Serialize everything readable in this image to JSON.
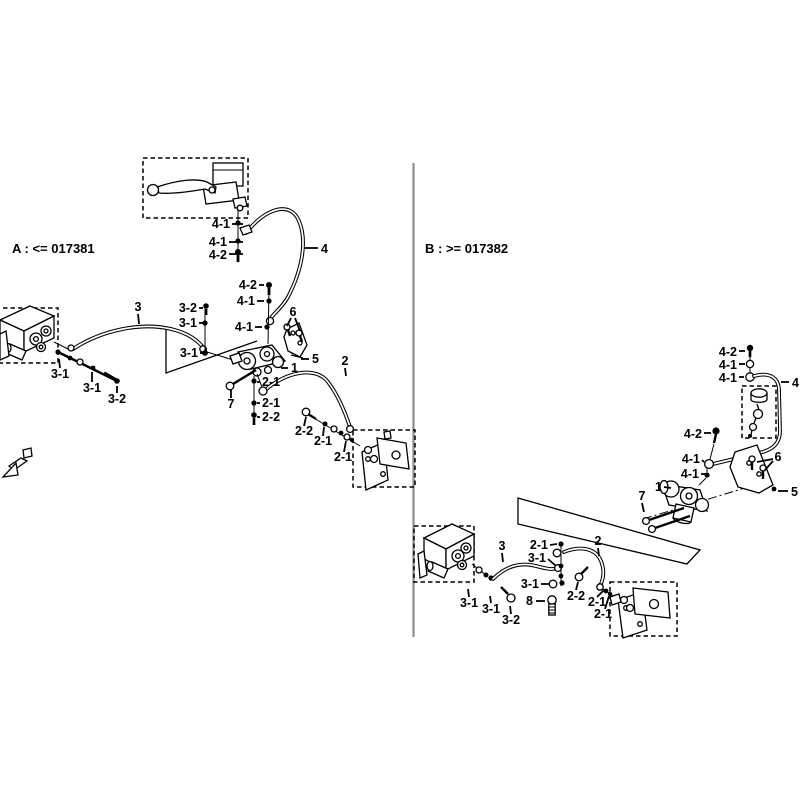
{
  "figure": {
    "background": "#ffffff",
    "line_color": "#000000",
    "divider_color": "#8c8c8c"
  },
  "sections": {
    "a": {
      "title": "A : <= 017381"
    },
    "b": {
      "title": "B : >= 017382"
    }
  },
  "callouts": [
    {
      "s": "A",
      "t": "4-1",
      "x": 230,
      "y": 228,
      "a": "end",
      "l": [
        232,
        224,
        243,
        224
      ]
    },
    {
      "s": "A",
      "t": "4-1",
      "x": 227,
      "y": 246,
      "a": "end",
      "l": [
        229,
        242,
        243,
        242
      ]
    },
    {
      "s": "A",
      "t": "4-2",
      "x": 227,
      "y": 259,
      "a": "end",
      "l": [
        229,
        254,
        243,
        254
      ]
    },
    {
      "s": "A",
      "t": "4",
      "x": 321,
      "y": 253,
      "a": "start",
      "l": [
        304,
        248,
        318,
        248
      ]
    },
    {
      "s": "A",
      "t": "4-2",
      "x": 257,
      "y": 289,
      "a": "end",
      "l": [
        259,
        285,
        264,
        285
      ]
    },
    {
      "s": "A",
      "t": "4-1",
      "x": 255,
      "y": 305,
      "a": "end",
      "l": [
        257,
        301,
        264,
        301
      ]
    },
    {
      "s": "A",
      "t": "4-1",
      "x": 253,
      "y": 331,
      "a": "end",
      "l": [
        255,
        327,
        262,
        327
      ]
    },
    {
      "s": "A",
      "t": "6",
      "x": 293,
      "y": 316,
      "a": "middle",
      "l": [
        291,
        318,
        287,
        326
      ],
      "l2": [
        295,
        318,
        300,
        331
      ]
    },
    {
      "s": "A",
      "t": "5",
      "x": 312,
      "y": 363,
      "a": "start",
      "l": [
        301,
        359,
        309,
        359
      ]
    },
    {
      "s": "A",
      "t": "1",
      "x": 291,
      "y": 372,
      "a": "start",
      "l": [
        281,
        368,
        288,
        368
      ]
    },
    {
      "s": "A",
      "t": "2",
      "x": 345,
      "y": 365,
      "a": "middle",
      "l": [
        345,
        368,
        346,
        376
      ]
    },
    {
      "s": "A",
      "t": "3",
      "x": 138,
      "y": 311,
      "a": "middle",
      "l": [
        138,
        314,
        139,
        324
      ]
    },
    {
      "s": "A",
      "t": "3-2",
      "x": 197,
      "y": 312,
      "a": "end",
      "l": [
        199,
        308,
        203,
        308
      ]
    },
    {
      "s": "A",
      "t": "3-1",
      "x": 197,
      "y": 327,
      "a": "end",
      "l": [
        199,
        323,
        203,
        323
      ]
    },
    {
      "s": "A",
      "t": "3-1",
      "x": 198,
      "y": 357,
      "a": "end",
      "l": [
        200,
        353,
        203,
        353
      ]
    },
    {
      "s": "A",
      "t": "3-1",
      "x": 60,
      "y": 378,
      "a": "middle",
      "l": [
        60,
        368,
        59,
        359
      ]
    },
    {
      "s": "A",
      "t": "3-1",
      "x": 92,
      "y": 392,
      "a": "middle",
      "l": [
        92,
        382,
        92,
        372
      ]
    },
    {
      "s": "A",
      "t": "3-2",
      "x": 117,
      "y": 403,
      "a": "middle",
      "l": [
        117,
        393,
        117,
        386
      ]
    },
    {
      "s": "A",
      "t": "7",
      "x": 231,
      "y": 408,
      "a": "middle",
      "l": [
        231,
        398,
        231,
        390
      ]
    },
    {
      "s": "A",
      "t": "2-1",
      "x": 262,
      "y": 386,
      "a": "start",
      "l": [
        257,
        382,
        260,
        382
      ]
    },
    {
      "s": "A",
      "t": "2-1",
      "x": 262,
      "y": 407,
      "a": "start",
      "l": [
        257,
        403,
        260,
        403
      ]
    },
    {
      "s": "A",
      "t": "2-2",
      "x": 262,
      "y": 421,
      "a": "start",
      "l": [
        257,
        417,
        260,
        417
      ]
    },
    {
      "s": "A",
      "t": "2-2",
      "x": 304,
      "y": 435,
      "a": "middle",
      "l": [
        304,
        426,
        306,
        417
      ]
    },
    {
      "s": "A",
      "t": "2-1",
      "x": 323,
      "y": 445,
      "a": "middle",
      "l": [
        323,
        436,
        324,
        427
      ]
    },
    {
      "s": "A",
      "t": "2-1",
      "x": 343,
      "y": 461,
      "a": "middle",
      "l": [
        344,
        452,
        346,
        441
      ]
    },
    {
      "s": "B",
      "t": "4-2",
      "x": 737,
      "y": 356,
      "a": "end",
      "l": [
        739,
        351,
        745,
        351
      ]
    },
    {
      "s": "B",
      "t": "4-1",
      "x": 737,
      "y": 369,
      "a": "end",
      "l": [
        739,
        364,
        745,
        364
      ]
    },
    {
      "s": "B",
      "t": "4-1",
      "x": 737,
      "y": 382,
      "a": "end",
      "l": [
        739,
        377,
        744,
        377
      ]
    },
    {
      "s": "B",
      "t": "4",
      "x": 792,
      "y": 387,
      "a": "start",
      "l": [
        781,
        382,
        789,
        382
      ]
    },
    {
      "s": "B",
      "t": "4-2",
      "x": 702,
      "y": 438,
      "a": "end",
      "l": [
        704,
        433,
        711,
        433
      ]
    },
    {
      "s": "B",
      "t": "4-1",
      "x": 700,
      "y": 463,
      "a": "end",
      "l": [
        702,
        460,
        704,
        462
      ]
    },
    {
      "s": "B",
      "t": "4-1",
      "x": 699,
      "y": 478,
      "a": "end",
      "l": [
        701,
        474,
        705,
        474
      ]
    },
    {
      "s": "B",
      "t": "1",
      "x": 662,
      "y": 491,
      "a": "end",
      "l": [
        664,
        487,
        671,
        488
      ]
    },
    {
      "s": "B",
      "t": "7",
      "x": 642,
      "y": 500,
      "a": "middle",
      "l": [
        642,
        503,
        644,
        512
      ]
    },
    {
      "s": "B",
      "t": "6",
      "x": 778,
      "y": 461,
      "a": "middle",
      "l": [
        773,
        459,
        757,
        462
      ],
      "l2": [
        773,
        461,
        765,
        470
      ]
    },
    {
      "s": "B",
      "t": "5",
      "x": 791,
      "y": 496,
      "a": "start",
      "l": [
        778,
        491,
        788,
        491
      ]
    },
    {
      "s": "B",
      "t": "2-1",
      "x": 548,
      "y": 549,
      "a": "end",
      "l": [
        550,
        545,
        557,
        544
      ]
    },
    {
      "s": "B",
      "t": "3",
      "x": 502,
      "y": 550,
      "a": "middle",
      "l": [
        502,
        553,
        503,
        562
      ]
    },
    {
      "s": "B",
      "t": "3-1",
      "x": 546,
      "y": 562,
      "a": "end",
      "l": [
        548,
        559,
        556,
        566
      ]
    },
    {
      "s": "B",
      "t": "3-1",
      "x": 539,
      "y": 588,
      "a": "end",
      "l": [
        541,
        584,
        549,
        584
      ]
    },
    {
      "s": "B",
      "t": "8",
      "x": 533,
      "y": 605,
      "a": "end",
      "l": [
        536,
        601,
        545,
        601
      ]
    },
    {
      "s": "B",
      "t": "2-2",
      "x": 576,
      "y": 600,
      "a": "middle",
      "l": [
        576,
        590,
        578,
        582
      ]
    },
    {
      "s": "B",
      "t": "2-1",
      "x": 597,
      "y": 606,
      "a": "middle",
      "l": [
        597,
        597,
        604,
        590
      ]
    },
    {
      "s": "B",
      "t": "2-1",
      "x": 603,
      "y": 618,
      "a": "middle",
      "l": [
        605,
        609,
        609,
        596
      ]
    },
    {
      "s": "B",
      "t": "2",
      "x": 598,
      "y": 545,
      "a": "middle",
      "l": [
        598,
        548,
        599,
        556
      ]
    },
    {
      "s": "B",
      "t": "3-1",
      "x": 469,
      "y": 607,
      "a": "middle",
      "l": [
        469,
        597,
        468,
        589
      ]
    },
    {
      "s": "B",
      "t": "3-1",
      "x": 491,
      "y": 613,
      "a": "middle",
      "l": [
        491,
        603,
        490,
        596
      ]
    },
    {
      "s": "B",
      "t": "3-2",
      "x": 511,
      "y": 624,
      "a": "middle",
      "l": [
        511,
        614,
        510,
        606
      ]
    }
  ]
}
